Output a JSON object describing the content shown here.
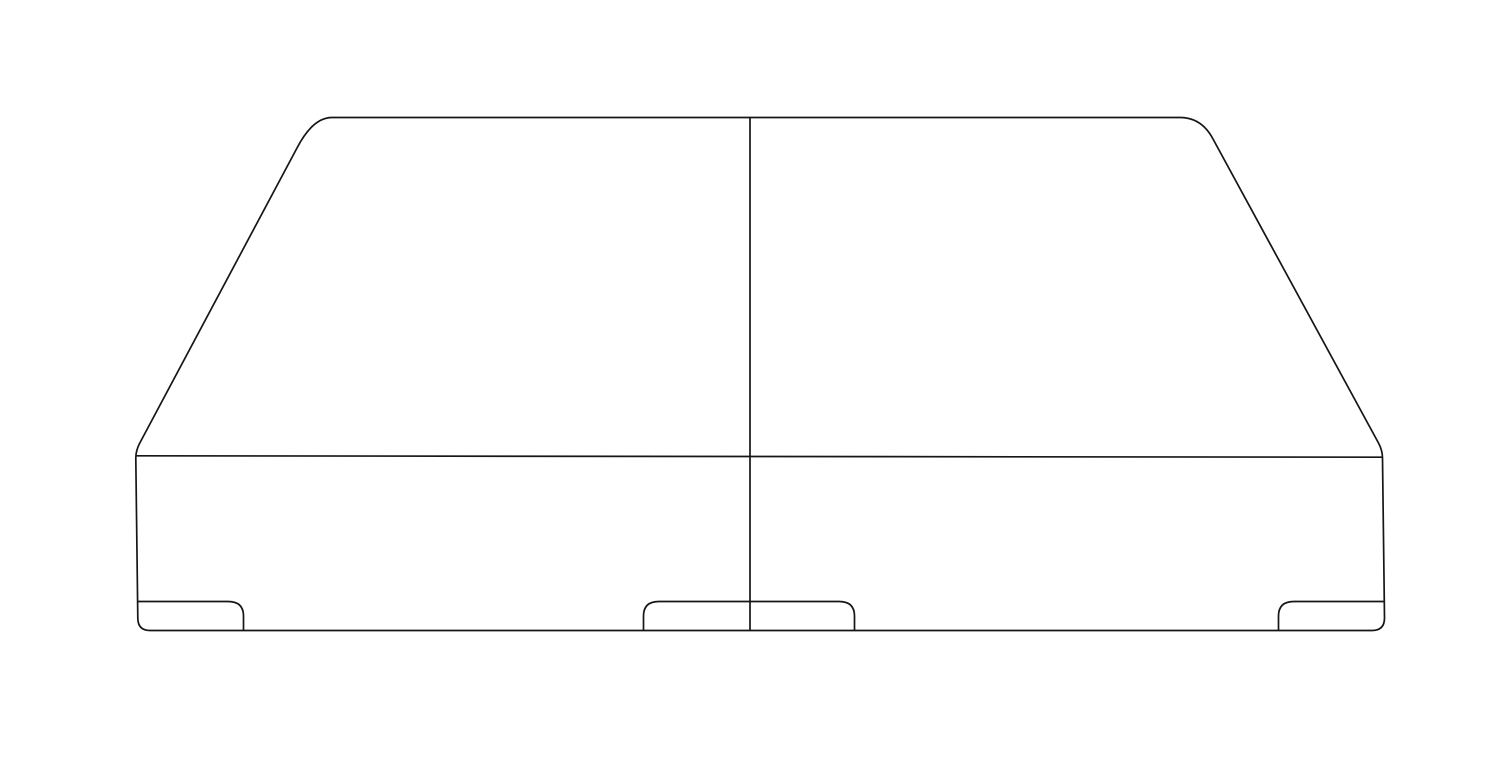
{
  "illustration": {
    "subject": "split-box-spring-foundation-front-view",
    "background_color": "#ffffff",
    "stroke_color": "#161616",
    "stroke_width": "1.7",
    "viewbox": "0 0 1500 768",
    "paths": {
      "outline": "M 332 117.5 L 1180 117.5 Q 1201.7 117.5 1213 139 L 1378.5 443 Q 1382.5 450.5 1382.5 458 L 1384.5 618 Q 1384.5 630.5 1372 630.5 L 150 630.5 Q 137.8 630.5 137.8 618 L 135.8 458 Q 135.8 450.5 139.8 443 L 297 148 Q 312.8 117.5 332 117.5 Z",
      "deck_edge": "M 136 455.8 L 1382.8 457.2",
      "center_divider": "M 750 117.5 L 750 630.5",
      "left_foot": "M 137.2 601.5 L 228 601.5 Q 243.5 601.5 243.5 616 L 243.5 630.2",
      "center_feet": "M 643.5 630.2 L 643.5 616 Q 643.5 601.5 659 601.5 L 839 601.5 Q 854.5 601.5 854.5 616 L 854.5 630.2",
      "right_foot": "M 1278.5 630.2 L 1278.5 616 Q 1278.5 601.5 1294 601.5 L 1384.3 601.5"
    }
  }
}
